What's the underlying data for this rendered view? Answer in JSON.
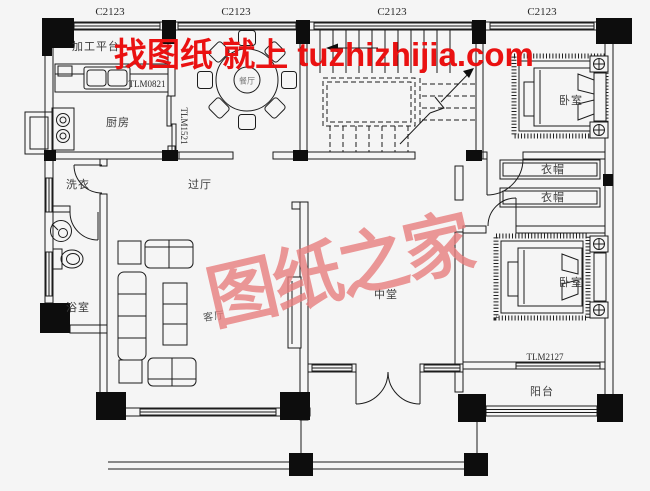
{
  "plan": {
    "watermark": {
      "headline": "找图纸 就上 tuzhizhijia.com",
      "brand": "图纸之家",
      "headline_color": "#ea1111",
      "brand_color": "#e87f7f"
    },
    "codes": {
      "window": "C2123",
      "kitchen_door": "TLM0821",
      "sliding_door": "TLM1521",
      "balcony_door": "TLM2127"
    },
    "rooms": {
      "platform": "加工平台",
      "kitchen": "厨房",
      "dining": "餐厅",
      "hall": "过厅",
      "laundry": "洗衣",
      "bath": "浴室",
      "living": "客厅",
      "central_hall": "中堂",
      "bedroom_top": "卧室",
      "bedroom_bottom": "卧室",
      "cloak_upper": "衣帽",
      "cloak_lower": "衣帽",
      "balcony": "阳台"
    },
    "colors": {
      "background": "#f5f5f5",
      "line": "#1c1c1c",
      "column": "#0d0d0d"
    }
  }
}
